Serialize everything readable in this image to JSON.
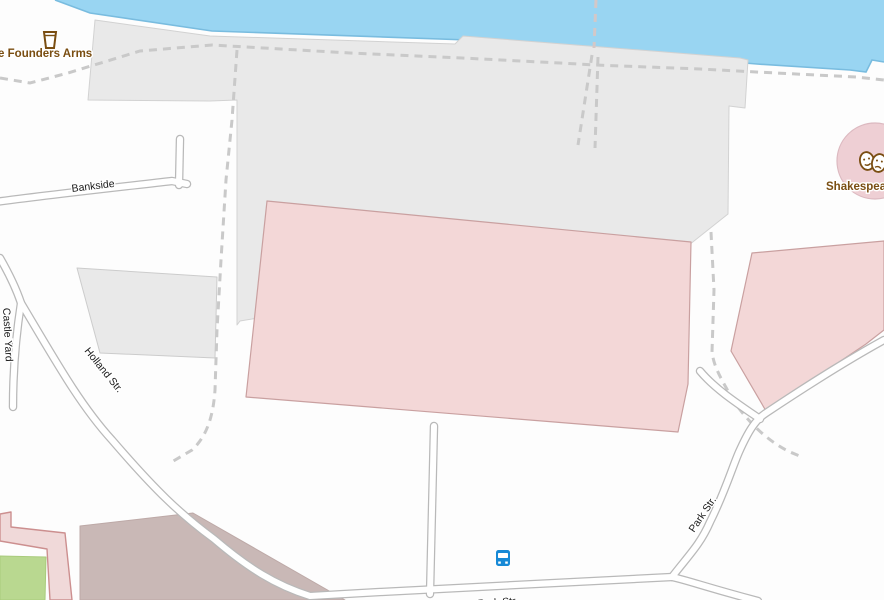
{
  "map": {
    "labels": {
      "founders_arms": "The Founders Arms",
      "bankside": "Bankside",
      "castle_yard": "Castle Yard",
      "holland_str": "Holland Str.",
      "park_str": "Park Str.",
      "park_str_bottom": "Park Str.",
      "shakespeare": "Shakespeare's Globe"
    },
    "icons": {
      "beer_mug": "beer-mug-icon",
      "theatre_masks": "theatre-masks-icon",
      "bus": "bus-icon"
    },
    "colors": {
      "water": "#99d5f2",
      "water_edge": "#79bcdf",
      "land": "#fdfdfd",
      "pedestrian_area": "#e9e9e9",
      "attraction_pink": "#f3d7d7",
      "theatre_circle": "#eecfd4",
      "building_mauve": "#c9b8b6",
      "building_pink": "#f0d9d9",
      "garden_green": "#b9d890",
      "road_casing": "#b9b9b9",
      "road_fill": "#ffffff",
      "footpath_dash": "#c9c9c9",
      "poi_text": "#7a4e12",
      "street_text": "#1a1a1a",
      "bus_blue": "#1789d6"
    }
  }
}
